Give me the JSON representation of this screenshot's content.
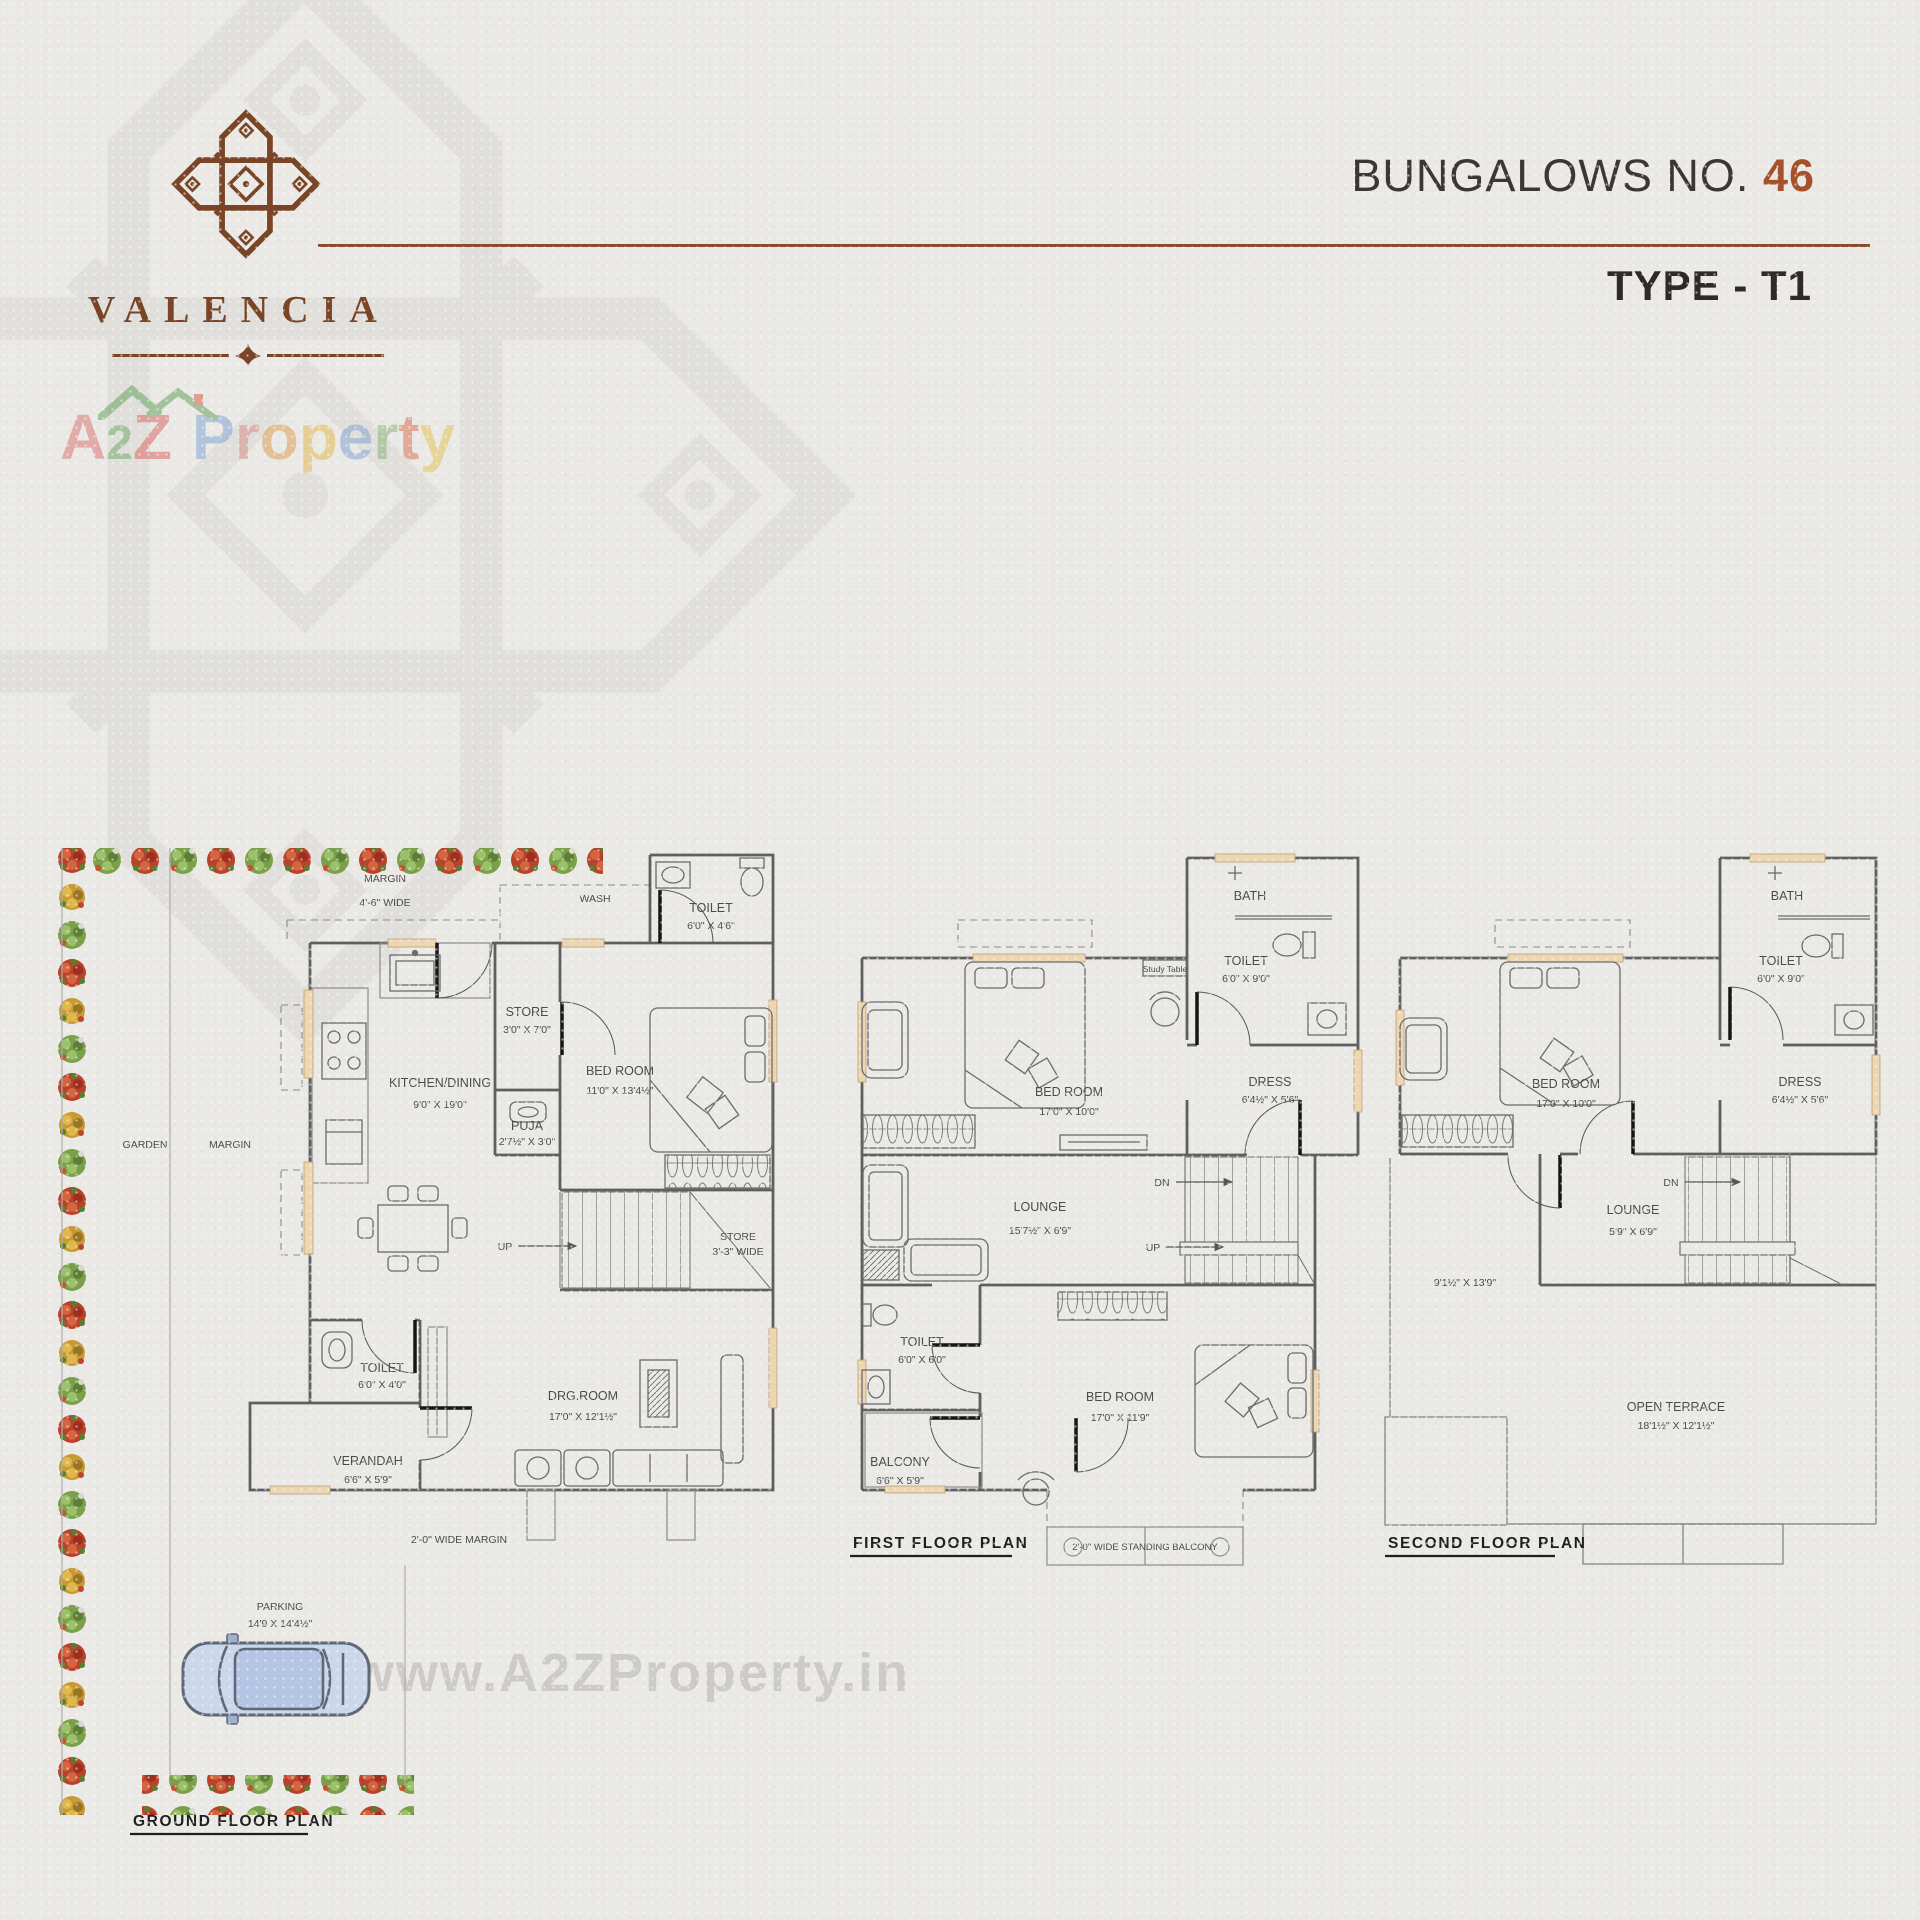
{
  "header": {
    "brand": "VALENCIA",
    "title_prefix": "BUNGALOWS NO. ",
    "title_number": "46",
    "subtitle": "TYPE - T1"
  },
  "watermark": {
    "a": "A",
    "two": "2",
    "z": "Z",
    "property": [
      "P",
      "r",
      "o",
      "p",
      "e",
      "r",
      "t",
      "y"
    ],
    "url": "www.A2ZProperty.in"
  },
  "palette": {
    "background": "#eae9e6",
    "accent_brown": "#8a4b2c",
    "logo_brown": "#7a4526",
    "number_orange": "#a5522c",
    "wall_gray": "#5f5f5f",
    "window_peach": "#edd6b2",
    "flower_red": "#b8422c",
    "flower_green": "#7ba04a",
    "flower_yellow": "#c79a33",
    "car_blue": "#ccd7ec"
  },
  "ground_floor": {
    "title": "GROUND FLOOR PLAN",
    "margin_top_1": "MARGIN",
    "margin_top_2": "4'-6\" WIDE",
    "wash": "WASH",
    "toilet_top_1": "TOILET",
    "toilet_top_2": "6'0\" X 4'6\"",
    "store_1": "STORE",
    "store_2": "3'0\" X 7'0\"",
    "kitchen_1": "KITCHEN/DINING",
    "kitchen_2": "9'0\" X 19'0\"",
    "puja_1": "PUJA",
    "puja_2": "2'7½\" X 3'0\"",
    "bedroom_1": "BED ROOM",
    "bedroom_2": "11'0\" X 13'4½\"",
    "up": "UP",
    "stair_store_1": "STORE",
    "stair_store_2": "3'-3\" WIDE",
    "toilet_1": "TOILET",
    "toilet_2": "6'0\" X 4'0\"",
    "drg_1": "DRG.ROOM",
    "drg_2": "17'0\" X 12'1½\"",
    "verandah_1": "VERANDAH",
    "verandah_2": "6'6\" X 5'9\"",
    "margin_bottom": "2'-0\" WIDE MARGIN",
    "garden": "GARDEN",
    "margin_left": "MARGIN",
    "parking_1": "PARKING",
    "parking_2": "14'9 X 14'4½\""
  },
  "first_floor": {
    "title": "FIRST FLOOR PLAN",
    "bath": "BATH",
    "toilet_top_1": "TOILET",
    "toilet_top_2": "6'0\" X 9'0\"",
    "study": "Study Table",
    "bedroom_top_1": "BED ROOM",
    "bedroom_top_2": "17'0\" X 10'0\"",
    "dress_1": "DRESS",
    "dress_2": "6'4½\" X 5'6\"",
    "lounge_1": "LOUNGE",
    "lounge_2": "15'7½\" X 6'9\"",
    "dn": "DN",
    "up": "UP",
    "toilet_1": "TOILET",
    "toilet_2": "6'0\" X 6'0\"",
    "bedroom_1": "BED ROO­M",
    "bedroom_2": "17'0\" X 11'9\"",
    "balcony_1": "BALCONY",
    "balcony_2": "6'6\" X 5'9\"",
    "standing_balcony": "2'-0\" WIDE STANDING BALCONY"
  },
  "second_floor": {
    "title": "SECOND FLOOR PLAN",
    "bath": "BATH",
    "toilet_1": "TOILET",
    "toilet_2": "6'0\" X 9'0\"",
    "bedroom_1": "BED ROOM",
    "bedroom_2": "17'0\" X 10'0\"",
    "dress_1": "DRESS",
    "dress_2": "6'4½\" X 5'6\"",
    "lounge_1": "LOUNGE",
    "lounge_2": "5'9\" X 6'9\"",
    "dn": "DN",
    "side_dim": "9'1½\" X 13'9\"",
    "terrace_1": "OPEN TERRACE",
    "terrace_2": "18'1½\" X 12'1½\""
  }
}
